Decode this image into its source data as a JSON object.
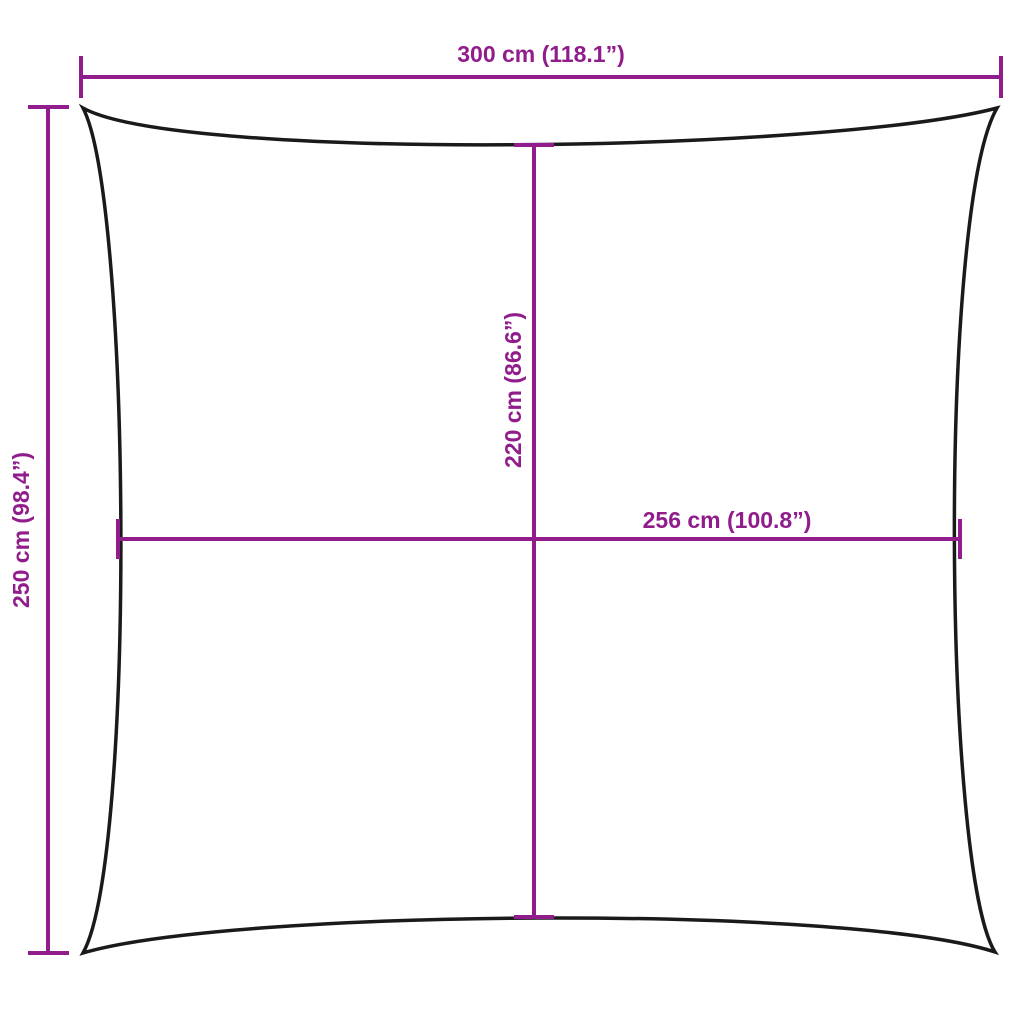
{
  "diagram": {
    "title": "shade-sail-dimension-diagram",
    "background_color": "#ffffff",
    "outline_color": "#1a1a1a",
    "dimension_color": "#911c8b",
    "dimensions": {
      "overall_width": {
        "label": "300 cm (118.1”)",
        "cm": 300,
        "inches": 118.1,
        "position": "top"
      },
      "overall_height": {
        "label": "250 cm (98.4”)",
        "cm": 250,
        "inches": 98.4,
        "position": "left"
      },
      "center_height": {
        "label": "220 cm (86.6”)",
        "cm": 220,
        "inches": 86.6,
        "position": "center-vertical"
      },
      "center_width": {
        "label": "256 cm (100.8”)",
        "cm": 256,
        "inches": 100.8,
        "position": "center-horizontal"
      }
    }
  }
}
